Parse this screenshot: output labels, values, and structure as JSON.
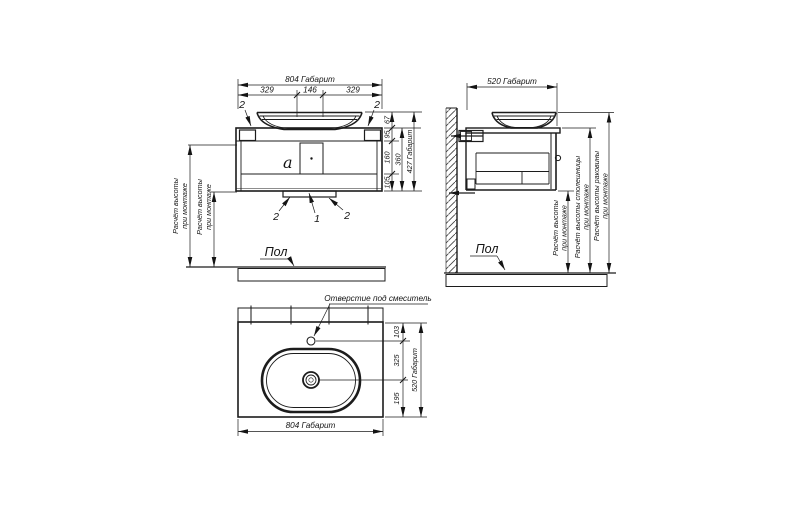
{
  "front": {
    "dim_total_width": "804 Габарит",
    "dims_top": [
      "329",
      "146",
      "329"
    ],
    "callout_top_left": "2",
    "callout_top_right": "2",
    "detail_label": "a",
    "dims_right": [
      "67",
      "95",
      "160",
      "105"
    ],
    "dim_body_height": "360",
    "dim_total_height": "427 Габарит",
    "callouts_bottom": [
      "2",
      "1",
      "2"
    ],
    "mount_height_line1": "Расчёт высоты",
    "mount_height_line2": "при монтаже",
    "floor_label": "Пол"
  },
  "side": {
    "dim_total_depth": "520 Габарит",
    "mount_height_line1": "Расчёт высоты",
    "mount_height_line2": "при монтаже",
    "countertop_height_line1": "Расчёт высоты столешницы",
    "countertop_height_line2": "при монтаже",
    "sink_height_line1": "Расчёт высоты раковины",
    "sink_height_line2": "при монтаже",
    "floor_label": "Пол"
  },
  "top": {
    "faucet_hole_label": "Отверстие под смеситель",
    "dims_right": [
      "103",
      "325",
      "195"
    ],
    "dim_total_depth": "520 Габарит",
    "dim_total_width": "804 Габарит"
  }
}
